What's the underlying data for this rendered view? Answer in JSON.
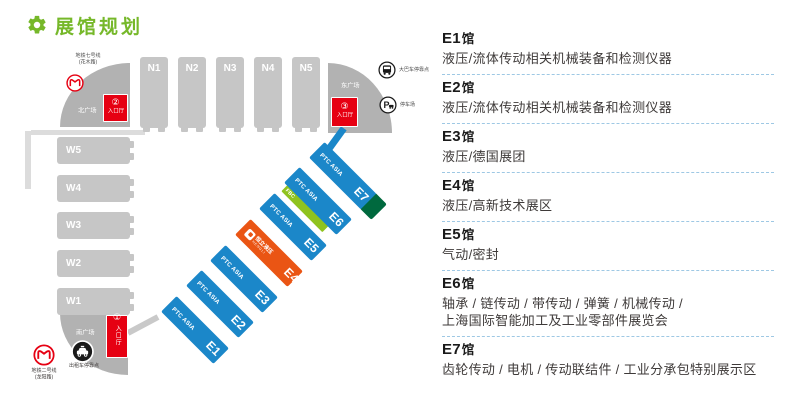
{
  "title": {
    "text": "展馆规划"
  },
  "map": {
    "north_halls": [
      "N1",
      "N2",
      "N3",
      "N4",
      "N5"
    ],
    "west_halls": [
      "W5",
      "W4",
      "W3",
      "W2",
      "W1"
    ],
    "east_halls": [
      {
        "id": "E1",
        "brand": "PTC ASIA"
      },
      {
        "id": "E2",
        "brand": "PTC ASIA"
      },
      {
        "id": "E3",
        "brand": "PTC ASIA"
      },
      {
        "id": "E4",
        "logo_text": "恒立液压",
        "logo_sub": "HENGLI"
      },
      {
        "id": "E5",
        "brand": "PTC ASIA"
      },
      {
        "id": "E6",
        "brand": "PTC ASIA",
        "stripe_label": "FBC"
      },
      {
        "id": "E7",
        "brand": "PTC ASIA"
      }
    ],
    "plazas": {
      "north": {
        "label": "北广场",
        "entrance_no": "②",
        "entrance_label": "入口厅",
        "metro": "地铁七号线\n(花木路)"
      },
      "east": {
        "label": "东广场",
        "entrance_no": "③",
        "entrance_label": "入口厅",
        "bus": "大巴车停靠点",
        "parking": "停车场"
      },
      "south": {
        "label": "南广场",
        "entrance_no": "①",
        "entrance_label": "入口厅",
        "metro": "地铁二号线\n(龙阳路)",
        "taxi": "出租车停靠点"
      }
    }
  },
  "legend": {
    "entries": [
      {
        "id": "E1",
        "suffix": "馆",
        "desc": "液压/流体传动相关机械装备和检测仪器"
      },
      {
        "id": "E2",
        "suffix": "馆",
        "desc": "液压/流体传动相关机械装备和检测仪器"
      },
      {
        "id": "E3",
        "suffix": "馆",
        "desc": "液压/德国展团"
      },
      {
        "id": "E4",
        "suffix": "馆",
        "desc": "液压/高新技术展区"
      },
      {
        "id": "E5",
        "suffix": "馆",
        "desc": "气动/密封"
      },
      {
        "id": "E6",
        "suffix": "馆",
        "desc": "轴承 / 链传动 / 带传动 / 弹簧 / 机械传动 /\n上海国际智能加工及工业零部件展览会"
      },
      {
        "id": "E7",
        "suffix": "馆",
        "desc": "齿轮传动 / 电机 / 传动联结件 / 工业分承包特别展示区"
      }
    ]
  },
  "colors": {
    "accent_green": "#76b82a",
    "hall_gray": "#c6c6c6",
    "plaza_gray": "#b2b2b2",
    "entrance_red": "#e60012",
    "hall_blue": "#1b87c9",
    "hall_orange": "#ea5514",
    "stripe_green": "#8fc31f",
    "cap_dark_green": "#00693e",
    "separator_blue": "#9ec8e4"
  }
}
